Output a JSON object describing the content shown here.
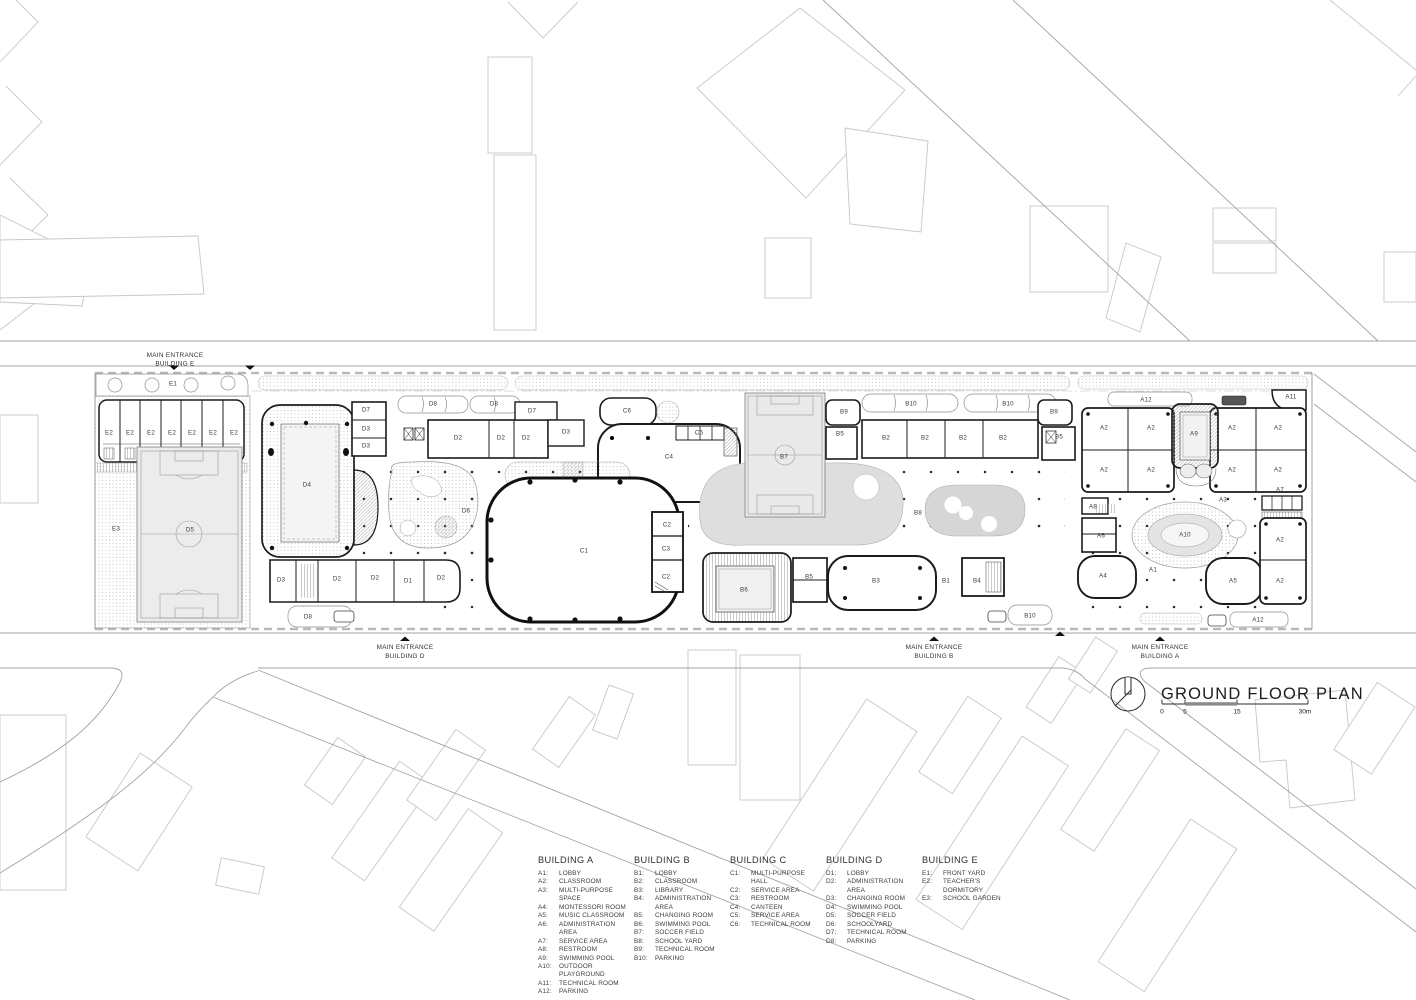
{
  "title_block": {
    "title": "GROUND FLOOR PLAN",
    "scale_ticks": [
      "0",
      "5",
      "15",
      "30m"
    ]
  },
  "entrances": [
    {
      "line1": "MAIN ENTRANCE",
      "line2": "BUILDING E"
    },
    {
      "line1": "MAIN ENTRANCE",
      "line2": "BUILDING D"
    },
    {
      "line1": "MAIN ENTRANCE",
      "line2": "BUILDING B"
    },
    {
      "line1": "MAIN ENTRANCE",
      "line2": "BUILDING A"
    }
  ],
  "legend": {
    "columns": [
      {
        "header": "BUILDING A",
        "items": [
          {
            "code": "A1:",
            "name": "LOBBY"
          },
          {
            "code": "A2:",
            "name": "CLASSROOM"
          },
          {
            "code": "A3:",
            "name": "MULTI-PURPOSE SPACE"
          },
          {
            "code": "A4:",
            "name": "MONTESSORI ROOM"
          },
          {
            "code": "A5:",
            "name": "MUSIC CLASSROOM"
          },
          {
            "code": "A6:",
            "name": "ADMINISTRATION AREA"
          },
          {
            "code": "A7:",
            "name": "SERVICE AREA"
          },
          {
            "code": "A8:",
            "name": "RESTROOM"
          },
          {
            "code": "A9:",
            "name": "SWIMMING POOL"
          },
          {
            "code": "A10:",
            "name": "OUTDOOR PLAYGROUND"
          },
          {
            "code": "A11:",
            "name": "TECHNICAL ROOM"
          },
          {
            "code": "A12:",
            "name": "PARKING"
          }
        ]
      },
      {
        "header": "BUILDING B",
        "items": [
          {
            "code": "B1:",
            "name": "LOBBY"
          },
          {
            "code": "B2:",
            "name": "CLASSROOM"
          },
          {
            "code": "B3:",
            "name": "LIBRARY"
          },
          {
            "code": "B4:",
            "name": "ADMINISTRATION AREA"
          },
          {
            "code": "B5:",
            "name": "CHANGING ROOM"
          },
          {
            "code": "B6:",
            "name": "SWIMMING POOL"
          },
          {
            "code": "B7:",
            "name": "SOCCER FIELD"
          },
          {
            "code": "B8:",
            "name": "SCHOOL YARD"
          },
          {
            "code": "B9:",
            "name": "TECHNICAL ROOM"
          },
          {
            "code": "B10:",
            "name": "PARKING"
          }
        ]
      },
      {
        "header": "BUILDING C",
        "items": [
          {
            "code": "C1:",
            "name": "MULTI-PURPOSE HALL"
          },
          {
            "code": "C2:",
            "name": "SERVICE AREA"
          },
          {
            "code": "C3:",
            "name": "RESTROOM"
          },
          {
            "code": "C4:",
            "name": "CANTEEN"
          },
          {
            "code": "C5:",
            "name": "SERVICE AREA"
          },
          {
            "code": "C6:",
            "name": "TECHNICAL ROOM"
          }
        ]
      },
      {
        "header": "BUILDING D",
        "items": [
          {
            "code": "D1:",
            "name": "LOBBY"
          },
          {
            "code": "D2:",
            "name": "ADMINISTRATION AREA"
          },
          {
            "code": "D3:",
            "name": "CHANGING ROOM"
          },
          {
            "code": "D4:",
            "name": "SWIMMING POOL"
          },
          {
            "code": "D5:",
            "name": "SOCCER FIELD"
          },
          {
            "code": "D6:",
            "name": "SCHOOLYARD"
          },
          {
            "code": "D7:",
            "name": "TECHNICAL ROOM"
          },
          {
            "code": "D8:",
            "name": "PARKING"
          }
        ]
      },
      {
        "header": "BUILDING E",
        "items": [
          {
            "code": "E1:",
            "name": "FRONT YARD"
          },
          {
            "code": "E2:",
            "name": "TEACHER'S DORMITORY"
          },
          {
            "code": "E3:",
            "name": "SCHOOL GARDEN"
          }
        ]
      }
    ]
  },
  "plan": {
    "room_labels": [
      {
        "t": "E1",
        "x": 173,
        "y": 384
      },
      {
        "t": "E2",
        "x": 109,
        "y": 433
      },
      {
        "t": "E2",
        "x": 130,
        "y": 433
      },
      {
        "t": "E2",
        "x": 151,
        "y": 433
      },
      {
        "t": "E2",
        "x": 172,
        "y": 433
      },
      {
        "t": "E2",
        "x": 192,
        "y": 433
      },
      {
        "t": "E2",
        "x": 213,
        "y": 433
      },
      {
        "t": "E2",
        "x": 234,
        "y": 433
      },
      {
        "t": "E3",
        "x": 116,
        "y": 529
      },
      {
        "t": "D5",
        "x": 190,
        "y": 530
      },
      {
        "t": "D4",
        "x": 307,
        "y": 485
      },
      {
        "t": "D7",
        "x": 366,
        "y": 410
      },
      {
        "t": "D3",
        "x": 366,
        "y": 429
      },
      {
        "t": "D3",
        "x": 366,
        "y": 446
      },
      {
        "t": "D8",
        "x": 433,
        "y": 404
      },
      {
        "t": "D8",
        "x": 494,
        "y": 404
      },
      {
        "t": "D7",
        "x": 532,
        "y": 411
      },
      {
        "t": "D2",
        "x": 458,
        "y": 438
      },
      {
        "t": "D2",
        "x": 501,
        "y": 438
      },
      {
        "t": "D2",
        "x": 526,
        "y": 438
      },
      {
        "t": "D3",
        "x": 566,
        "y": 432
      },
      {
        "t": "D6",
        "x": 466,
        "y": 511
      },
      {
        "t": "D3",
        "x": 281,
        "y": 580
      },
      {
        "t": "D2",
        "x": 337,
        "y": 579
      },
      {
        "t": "D2",
        "x": 375,
        "y": 578
      },
      {
        "t": "D1",
        "x": 408,
        "y": 581
      },
      {
        "t": "D2",
        "x": 441,
        "y": 578
      },
      {
        "t": "D8",
        "x": 308,
        "y": 617
      },
      {
        "t": "C6",
        "x": 627,
        "y": 411
      },
      {
        "t": "C5",
        "x": 699,
        "y": 433
      },
      {
        "t": "C4",
        "x": 669,
        "y": 457
      },
      {
        "t": "C1",
        "x": 584,
        "y": 551
      },
      {
        "t": "C2",
        "x": 667,
        "y": 525
      },
      {
        "t": "C3",
        "x": 666,
        "y": 549
      },
      {
        "t": "C2",
        "x": 666,
        "y": 577
      },
      {
        "t": "B7",
        "x": 784,
        "y": 457
      },
      {
        "t": "B9",
        "x": 844,
        "y": 412
      },
      {
        "t": "B9",
        "x": 1054,
        "y": 412
      },
      {
        "t": "B5",
        "x": 840,
        "y": 434
      },
      {
        "t": "B5",
        "x": 1059,
        "y": 437
      },
      {
        "t": "B10",
        "x": 911,
        "y": 404
      },
      {
        "t": "B10",
        "x": 1008,
        "y": 404
      },
      {
        "t": "B2",
        "x": 886,
        "y": 438
      },
      {
        "t": "B2",
        "x": 925,
        "y": 438
      },
      {
        "t": "B2",
        "x": 963,
        "y": 438
      },
      {
        "t": "B2",
        "x": 1003,
        "y": 438
      },
      {
        "t": "B8",
        "x": 918,
        "y": 513
      },
      {
        "t": "B6",
        "x": 744,
        "y": 590
      },
      {
        "t": "B5",
        "x": 809,
        "y": 577
      },
      {
        "t": "B3",
        "x": 876,
        "y": 581
      },
      {
        "t": "B1",
        "x": 946,
        "y": 581
      },
      {
        "t": "B4",
        "x": 977,
        "y": 581
      },
      {
        "t": "B10",
        "x": 1030,
        "y": 616
      },
      {
        "t": "A12",
        "x": 1146,
        "y": 400
      },
      {
        "t": "A11",
        "x": 1291,
        "y": 397
      },
      {
        "t": "A2",
        "x": 1104,
        "y": 428
      },
      {
        "t": "A2",
        "x": 1151,
        "y": 428
      },
      {
        "t": "A2",
        "x": 1232,
        "y": 428
      },
      {
        "t": "A2",
        "x": 1278,
        "y": 428
      },
      {
        "t": "A9",
        "x": 1194,
        "y": 434
      },
      {
        "t": "A2",
        "x": 1104,
        "y": 470
      },
      {
        "t": "A2",
        "x": 1151,
        "y": 470
      },
      {
        "t": "A2",
        "x": 1232,
        "y": 470
      },
      {
        "t": "A2",
        "x": 1278,
        "y": 470
      },
      {
        "t": "A3",
        "x": 1223,
        "y": 500
      },
      {
        "t": "A7",
        "x": 1280,
        "y": 490
      },
      {
        "t": "A8",
        "x": 1093,
        "y": 507
      },
      {
        "t": "A6",
        "x": 1101,
        "y": 536
      },
      {
        "t": "A10",
        "x": 1185,
        "y": 535
      },
      {
        "t": "A4",
        "x": 1103,
        "y": 576
      },
      {
        "t": "A1",
        "x": 1153,
        "y": 570
      },
      {
        "t": "A5",
        "x": 1233,
        "y": 581
      },
      {
        "t": "A2",
        "x": 1280,
        "y": 540
      },
      {
        "t": "A2",
        "x": 1280,
        "y": 581
      },
      {
        "t": "A12",
        "x": 1258,
        "y": 620
      }
    ]
  }
}
